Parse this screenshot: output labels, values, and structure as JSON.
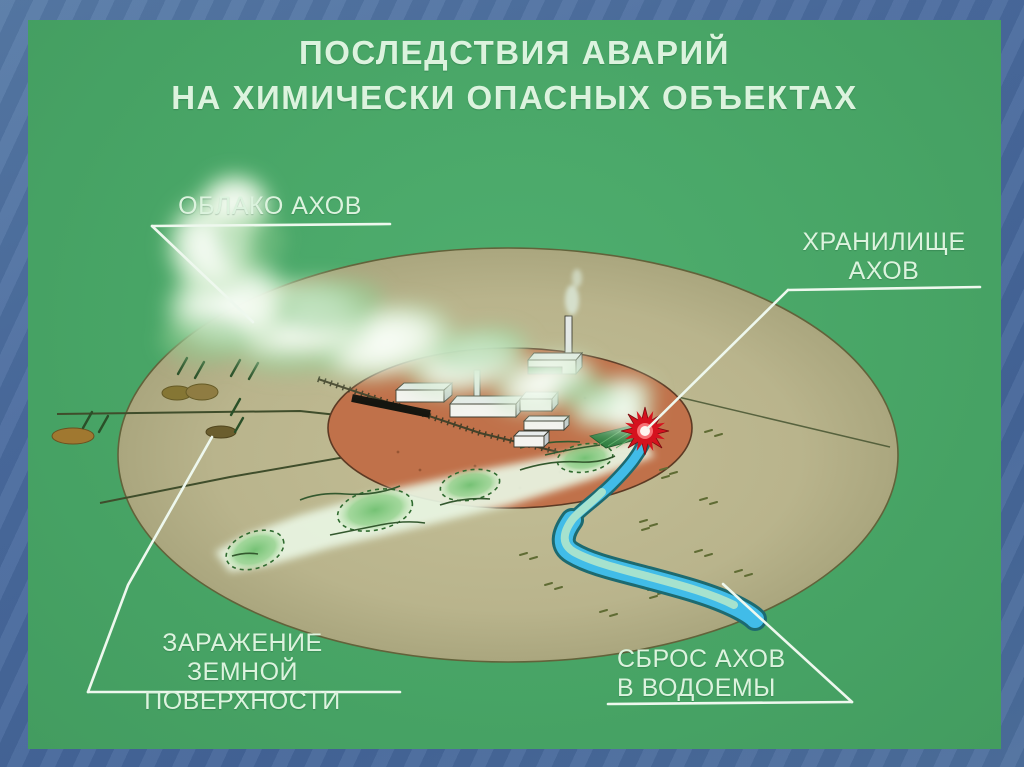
{
  "title": {
    "line1": "ПОСЛЕДСТВИЯ АВАРИЙ",
    "line2": "НА ХИМИЧЕСКИ ОПАСНЫХ ОБЪЕКТАХ"
  },
  "labels": {
    "cloud": "ОБЛАКО АХОВ",
    "storage": {
      "line1": "ХРАНИЛИЩЕ",
      "line2": "АХОВ"
    },
    "ground": {
      "line1": "ЗАРАЖЕНИЕ",
      "line2": "ЗЕМНОЙ ПОВЕРХНОСТИ"
    },
    "water": {
      "line1": "СБРОС АХОВ",
      "line2": "В ВОДОЕМЫ"
    }
  },
  "colors": {
    "frame_blue": "#4a6b9e",
    "panel_green": "#4aa568",
    "terrain_tan": "#b9b48c",
    "industrial_zone_orange": "#c0714a",
    "contamination_green": "#8fd08f",
    "river_blue": "#41bce8",
    "river_outline": "#1d6a70",
    "explosion_red": "#d5121e",
    "label_text": "#dcf3de",
    "leader_white": "#eef8ee"
  }
}
